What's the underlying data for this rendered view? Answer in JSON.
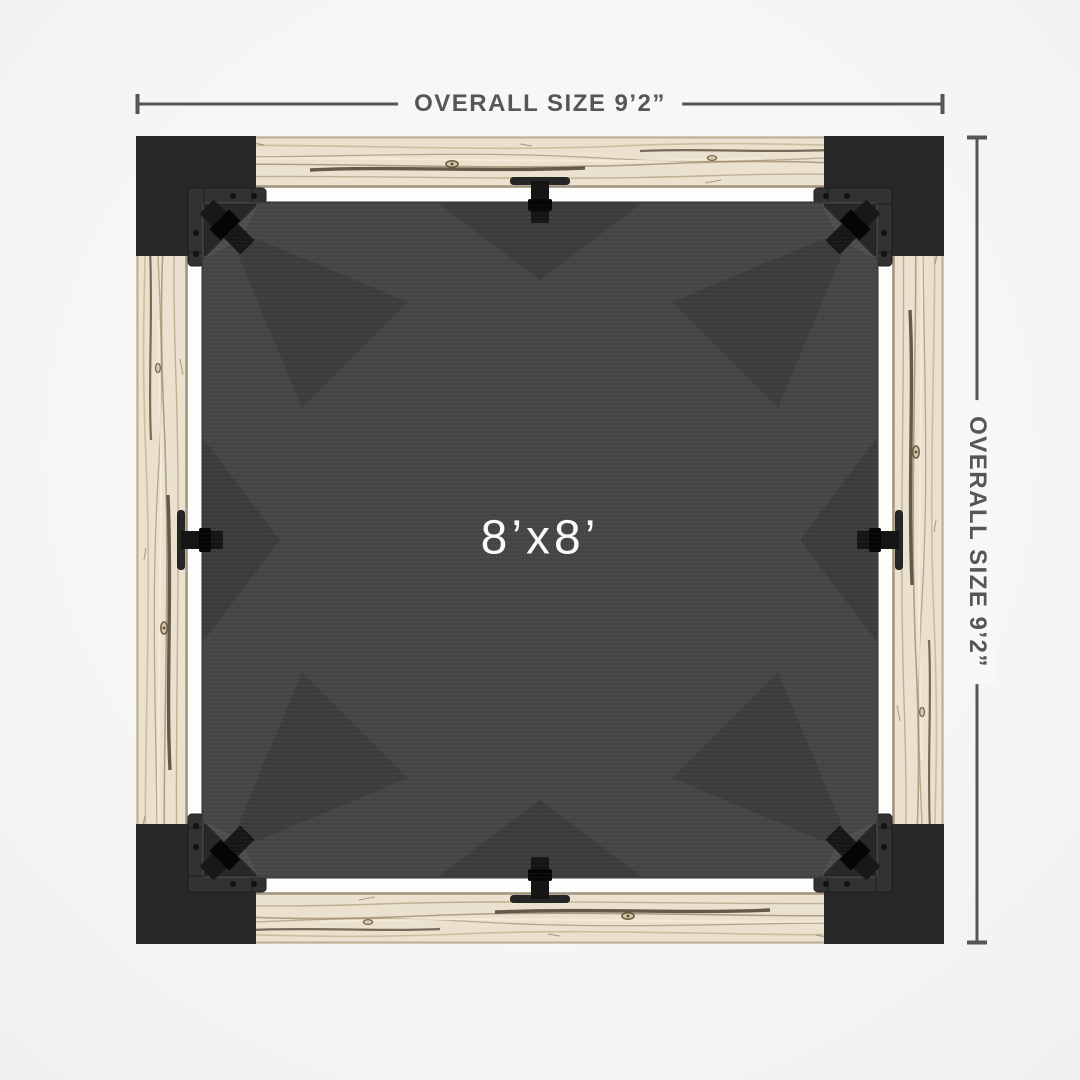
{
  "labels": {
    "overall_size_top": "OVERALL SIZE 9’2”",
    "overall_size_right": "OVERALL SIZE 9’2”",
    "canopy_size": "8’x8’"
  },
  "colors": {
    "background": "#f7f6f4",
    "dimension_lines_and_text": "#55565a",
    "wood_beam": "#ebe1cf",
    "corner_post": "#282828",
    "canopy_fabric": "#464646",
    "hardware": "#171717",
    "inner_gap": "#fdfdfc",
    "canopy_label_text": "#fafafa"
  }
}
